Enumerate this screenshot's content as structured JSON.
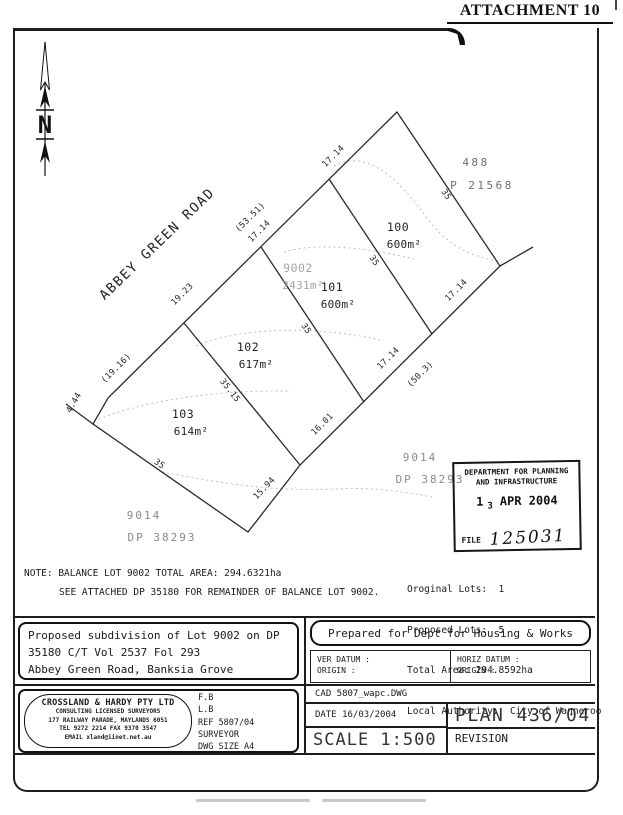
{
  "header": {
    "attachment": "ATTACHMENT 10"
  },
  "plan": {
    "road_name": "ABBEY GREEN ROAD",
    "north": "N",
    "lots": {
      "lot100": {
        "num": "100",
        "area": "600m²"
      },
      "lot101": {
        "num": "101",
        "area": "600m²"
      },
      "lot102": {
        "num": "102",
        "area": "617m²"
      },
      "lot103": {
        "num": "103",
        "area": "614m²"
      },
      "lot9002": {
        "num": "9002",
        "area": "2431m²"
      }
    },
    "adjoining": {
      "north_lot": "488",
      "north_plan": "P 21568",
      "east_lot": "9014",
      "east_plan": "DP 38293",
      "south_lot": "9014",
      "south_plan": "DP 38293"
    },
    "dims": {
      "road_total": "(53.51)",
      "road_seg_100": "17.14",
      "road_seg_101": "17.14",
      "road_seg_102": "19.23",
      "road_seg_103": "(19.16)",
      "road_jog": "4.44",
      "ne_width": "35",
      "div_100_101": "35",
      "div_101_102": "35",
      "div_102_103": "35.15",
      "sw_width": "35",
      "se_seg_103": "15.94",
      "se_seg_102": "16.01",
      "se_seg_101": "17.14",
      "se_seg_100": "17.14",
      "se_total": "(50.3)"
    }
  },
  "stamp": {
    "line1": "DEPARTMENT FOR PLANNING",
    "line2": "AND INFRASTRUCTURE",
    "date_day": "1",
    "date_day2": "3",
    "date_rest": "APR 2004",
    "file_label": "FILE",
    "file_number": "125031"
  },
  "summary": {
    "original": "Oroginal Lots:  1",
    "proposed": "Proposed Lots:  5",
    "total": "Total Area: 294.8592ha",
    "authority": "Local Authority:  City of Wanneroo"
  },
  "notes": {
    "line1": "NOTE: BALANCE LOT 9002 TOTAL AREA: 294.6321ha",
    "line2": "SEE ATTACHED DP 35180 FOR REMAINDER OF BALANCE LOT 9002."
  },
  "title_block": {
    "description_l1": "Proposed subdivision of Lot 9002 on DP",
    "description_l2": "35180 C/T Vol 2537 Fol 293",
    "description_l3": "Abbey Green Road, Banksia Grove",
    "prepared_for": "Prepared for Dept for Housing & Works",
    "ver_datum": "VER DATUM :",
    "ver_origin": "ORIGIN :",
    "horiz_datum": "HORIZ DATUM :",
    "horiz_origin": "ORIGIN :",
    "cad": "CAD 5807_wapc.DWG",
    "date": "DATE 16/03/2004",
    "plan_no": "PLAN 436/04",
    "scale": "SCALE 1:500",
    "revision": "REVISION",
    "firm": {
      "name": "CROSSLAND & HARDY PTY LTD",
      "line2": "CONSULTING LICENSED SURVEYORS",
      "line3": "177 RAILWAY PARADE, MAYLANDS 6051",
      "line4": "TEL 9272 2214      FAX 9370 3547",
      "line5": "EMAIL xland@iinet.net.au"
    },
    "refs": {
      "fb": "F.B",
      "lb": "L.B",
      "ref": "REF 5807/04",
      "surveyor": "SURVEYOR",
      "dwg": "DWG SIZE A4"
    }
  }
}
